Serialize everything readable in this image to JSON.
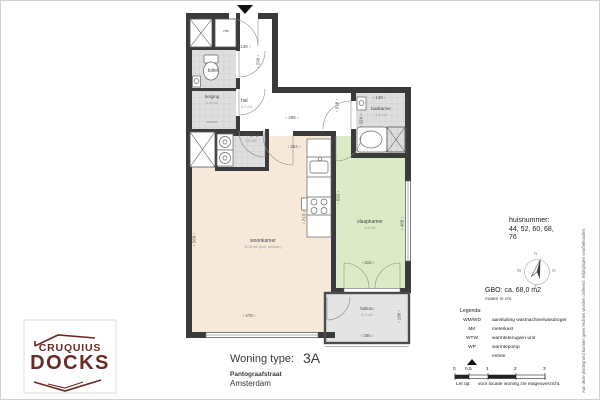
{
  "sheet": {
    "title_label": "Woning type:",
    "type": "3A",
    "street": "Pantograafstraat",
    "city": "Amsterdam"
  },
  "logo": {
    "line1": "CRUQUIUS",
    "line2": "DOCKS",
    "color": "#6b2a23"
  },
  "info": {
    "huisnummer_label": "huisnummer:",
    "huisnummer_line1": "44, 52, 60, 68,",
    "huisnummer_line2": "76",
    "gbo": "GBO: ca. 68,0 m2",
    "maten": "maten in cm."
  },
  "compass": {
    "n": "N",
    "o": "O",
    "z": "Z",
    "w": "W"
  },
  "legend": {
    "title": "Legenda:",
    "rows": [
      {
        "term": "WM/WD",
        "desc": "aansluiting wasmachine/wasdroger"
      },
      {
        "term": "MK",
        "desc": "meterkast"
      },
      {
        "term": "WTW",
        "desc": "warmteterugwin-unit"
      },
      {
        "term": "WP",
        "desc": "warmtepomp"
      },
      {
        "term": "",
        "icon": "entree-arrow",
        "desc": "entree"
      }
    ],
    "scale_ticks": [
      "0",
      "0,5",
      "1",
      "2",
      "3"
    ],
    "note_label": "Let op:",
    "note": "voor locatie woning zie etageoverzicht."
  },
  "disclaimer": "Aan deze plattegrond kunnen geen rechten worden ontleend. Wijzigingen voorbehouden.",
  "rooms": {
    "hal": {
      "name": "hal",
      "area": "8,0 m2"
    },
    "toilet": {
      "name": "toilet"
    },
    "mk": {
      "name": "mk"
    },
    "berging1": {
      "name": "berging",
      "area": "1,4 m2",
      "sub": "wm/wd"
    },
    "berging2": {
      "name": "berging",
      "area": "2,4 m2"
    },
    "badkamer": {
      "name": "badkamer",
      "area": "4,1 m2"
    },
    "woonkamer": {
      "name": "woonkamer",
      "area": "30,8 m2 (incl. keuken)"
    },
    "slaapkamer": {
      "name": "slaapkamer",
      "area": "9,6 m2"
    },
    "balkon": {
      "name": "balkon",
      "area": "5,2 m2"
    }
  },
  "dims": {
    "entry_width": "136",
    "entry_height": "290",
    "hal_width": "496",
    "hal_side": "318",
    "badkamer_width": "139",
    "badkamer_height": "310",
    "woonkamer_top": "252",
    "woonkamer_left": "560",
    "woonkamer_bottom": "478",
    "kitchen_wall": "713",
    "slaapkamer_left": "592",
    "slaapkamer_right": "488",
    "slaapkamer_bottom": "316",
    "balkon_width": "285",
    "balkon_height": "180"
  },
  "colors": {
    "wall": "#3b3b3b",
    "woonkamer": "#f6e9da",
    "slaapkamer": "#dcebc5",
    "balkon": "#e4e4e4",
    "wet_room": "#dedede",
    "logo": "#6b2a23"
  }
}
